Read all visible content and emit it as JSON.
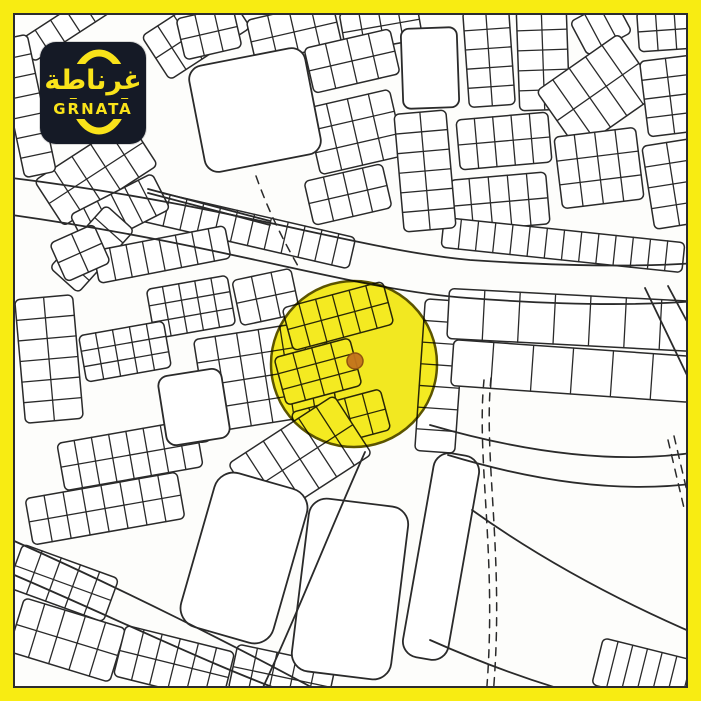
{
  "frame": {
    "border_color": "#f8ec12",
    "inner_line_color": "#2d2d2d",
    "map_bg": "#fdfdfb",
    "border_width_px": 13
  },
  "logo": {
    "arabic": "غرناطة",
    "latin": "GRNATA",
    "bg_color": "#151a26",
    "accent_color": "#f9e31a"
  },
  "map": {
    "ink": "#2a2a2a",
    "highlight_circle": {
      "cx": 354,
      "cy": 364,
      "r": 83,
      "fill": "#f2e702",
      "stroke": "#5c5400"
    },
    "marker": {
      "cx": 355,
      "cy": 361,
      "r": 8,
      "fill": "#c2731c",
      "stroke": "#8f5210"
    },
    "blocks": [
      {
        "x": 148,
        "y": 6,
        "w": 96,
        "h": 52,
        "rot": -33,
        "rows": 2,
        "cols": 5
      },
      {
        "x": 18,
        "y": 8,
        "w": 110,
        "h": 26,
        "rot": -33,
        "rows": 1,
        "cols": 6
      },
      {
        "x": 40,
        "y": 146,
        "w": 112,
        "h": 54,
        "rot": -33,
        "rows": 2,
        "cols": 5
      },
      {
        "x": 10,
        "y": 36,
        "w": 32,
        "h": 140,
        "rot": -12,
        "rows": 7,
        "cols": 1
      },
      {
        "x": 180,
        "y": 12,
        "w": 58,
        "h": 42,
        "rot": -13,
        "rows": 2,
        "cols": 3
      },
      {
        "x": 250,
        "y": 10,
        "w": 88,
        "h": 44,
        "rot": -13,
        "rows": 2,
        "cols": 4
      },
      {
        "x": 342,
        "y": 6,
        "w": 78,
        "h": 40,
        "rot": -10,
        "rows": 2,
        "cols": 4
      },
      {
        "x": 308,
        "y": 38,
        "w": 88,
        "h": 46,
        "rot": -13,
        "rows": 2,
        "cols": 4
      },
      {
        "x": 312,
        "y": 98,
        "w": 86,
        "h": 68,
        "rot": -13,
        "rows": 3,
        "cols": 4
      },
      {
        "x": 308,
        "y": 172,
        "w": 80,
        "h": 45,
        "rot": -13,
        "rows": 2,
        "cols": 4
      },
      {
        "x": 232,
        "y": 80,
        "w": 64,
        "h": 30,
        "rot": -11,
        "rows": 2,
        "cols": 3
      },
      {
        "x": 222,
        "y": 116,
        "w": 76,
        "h": 36,
        "rot": -11,
        "rows": 2,
        "cols": 4
      },
      {
        "x": 130,
        "y": 212,
        "w": 225,
        "h": 32,
        "rot": 13,
        "rows": 1,
        "cols": 13
      },
      {
        "x": 74,
        "y": 192,
        "w": 92,
        "h": 40,
        "rot": -27,
        "rows": 1,
        "cols": 6
      },
      {
        "x": 50,
        "y": 230,
        "w": 84,
        "h": 38,
        "rot": -48,
        "rows": 1,
        "cols": 5
      },
      {
        "x": 466,
        "y": 10,
        "w": 46,
        "h": 96,
        "rot": -4,
        "rows": 5,
        "cols": 2
      },
      {
        "x": 518,
        "y": 10,
        "w": 50,
        "h": 100,
        "rot": -2,
        "rows": 5,
        "cols": 2
      },
      {
        "x": 576,
        "y": 8,
        "w": 50,
        "h": 38,
        "rot": -28,
        "rows": 1,
        "cols": 3
      },
      {
        "x": 548,
        "y": 56,
        "w": 100,
        "h": 72,
        "rot": -35,
        "rows": 2,
        "cols": 5
      },
      {
        "x": 638,
        "y": 10,
        "w": 56,
        "h": 40,
        "rot": -4,
        "rows": 2,
        "cols": 3
      },
      {
        "x": 644,
        "y": 58,
        "w": 52,
        "h": 76,
        "rot": -7,
        "rows": 4,
        "cols": 2
      },
      {
        "x": 648,
        "y": 142,
        "w": 50,
        "h": 84,
        "rot": -9,
        "rows": 4,
        "cols": 2
      },
      {
        "x": 458,
        "y": 116,
        "w": 92,
        "h": 50,
        "rot": -5,
        "rows": 2,
        "cols": 5
      },
      {
        "x": 558,
        "y": 132,
        "w": 82,
        "h": 72,
        "rot": -7,
        "rows": 3,
        "cols": 4
      },
      {
        "x": 452,
        "y": 176,
        "w": 96,
        "h": 52,
        "rot": -5,
        "rows": 2,
        "cols": 5
      },
      {
        "x": 442,
        "y": 230,
        "w": 242,
        "h": 30,
        "rot": 6,
        "rows": 1,
        "cols": 14
      },
      {
        "x": 399,
        "y": 112,
        "w": 52,
        "h": 118,
        "rot": -5,
        "rows": 6,
        "cols": 2
      },
      {
        "x": 95,
        "y": 238,
        "w": 134,
        "h": 33,
        "rot": -11,
        "rows": 1,
        "cols": 8
      },
      {
        "x": 56,
        "y": 232,
        "w": 48,
        "h": 42,
        "rot": -24,
        "rows": 2,
        "cols": 2
      },
      {
        "x": 150,
        "y": 282,
        "w": 82,
        "h": 50,
        "rot": -10,
        "rows": 3,
        "cols": 5
      },
      {
        "x": 82,
        "y": 328,
        "w": 86,
        "h": 47,
        "rot": -10,
        "rows": 3,
        "cols": 5
      },
      {
        "x": 20,
        "y": 297,
        "w": 58,
        "h": 124,
        "rot": -5,
        "rows": 6,
        "cols": 2
      },
      {
        "x": 200,
        "y": 329,
        "w": 131,
        "h": 94,
        "rot": -9,
        "rows": 4,
        "cols": 6
      },
      {
        "x": 236,
        "y": 274,
        "w": 60,
        "h": 46,
        "rot": -12,
        "rows": 2,
        "cols": 3
      },
      {
        "x": 60,
        "y": 431,
        "w": 140,
        "h": 48,
        "rot": -10,
        "rows": 2,
        "cols": 8
      },
      {
        "x": 28,
        "y": 485,
        "w": 154,
        "h": 47,
        "rot": -10,
        "rows": 2,
        "cols": 8
      },
      {
        "x": 196,
        "y": 428,
        "w": 14,
        "h": 14,
        "rot": -9,
        "rows": 1,
        "cols": 1
      },
      {
        "x": 286,
        "y": 294,
        "w": 104,
        "h": 44,
        "rot": -15,
        "rows": 2,
        "cols": 6
      },
      {
        "x": 279,
        "y": 347,
        "w": 78,
        "h": 49,
        "rot": -15,
        "rows": 3,
        "cols": 4
      },
      {
        "x": 295,
        "y": 400,
        "w": 92,
        "h": 42,
        "rot": -15,
        "rows": 2,
        "cols": 5
      },
      {
        "x": 237,
        "y": 424,
        "w": 126,
        "h": 70,
        "rot": -33,
        "rows": 2,
        "cols": 6
      },
      {
        "x": 420,
        "y": 300,
        "w": 40,
        "h": 152,
        "rot": 4,
        "rows": 7,
        "cols": 1
      },
      {
        "x": 448,
        "y": 295,
        "w": 248,
        "h": 50,
        "rot": 3,
        "rows": 1,
        "cols": 7
      },
      {
        "x": 452,
        "y": 348,
        "w": 240,
        "h": 46,
        "rot": 4,
        "rows": 1,
        "cols": 6
      },
      {
        "x": 12,
        "y": 560,
        "w": 102,
        "h": 46,
        "rot": 20,
        "rows": 2,
        "cols": 5
      },
      {
        "x": 14,
        "y": 612,
        "w": 106,
        "h": 56,
        "rot": 17,
        "rows": 2,
        "cols": 5
      },
      {
        "x": 118,
        "y": 638,
        "w": 112,
        "h": 52,
        "rot": 14,
        "rows": 2,
        "cols": 6
      },
      {
        "x": 232,
        "y": 654,
        "w": 100,
        "h": 46,
        "rot": 12,
        "rows": 2,
        "cols": 5
      },
      {
        "x": 596,
        "y": 650,
        "w": 106,
        "h": 48,
        "rot": 14,
        "rows": 1,
        "cols": 7
      }
    ],
    "open_parcels": [
      {
        "x": 196,
        "y": 56,
        "w": 118,
        "h": 108,
        "rot": -11,
        "rx": 14
      },
      {
        "x": 402,
        "y": 28,
        "w": 56,
        "h": 80,
        "rot": -2,
        "rx": 8
      },
      {
        "x": 162,
        "y": 372,
        "w": 64,
        "h": 70,
        "rot": -9,
        "rx": 10
      },
      {
        "x": 196,
        "y": 478,
        "w": 96,
        "h": 160,
        "rot": 16,
        "rx": 20
      },
      {
        "x": 300,
        "y": 502,
        "w": 100,
        "h": 174,
        "rot": 7,
        "rx": 18
      },
      {
        "x": 418,
        "y": 453,
        "w": 46,
        "h": 207,
        "rot": 10,
        "rx": 16
      }
    ],
    "road_edges": [
      "M12 178 C230 205 360 250 470 260 C560 266 640 267 697 263",
      "M12 215 C230 246 355 290 468 298 C560 305 635 306 697 301",
      "M148 189 L270 221",
      "M148 193 L270 225",
      "M12 540 C120 588 240 648 335 700",
      "M12 574 C115 618 225 672 308 700",
      "M365 452 C330 530 295 620 258 698",
      "M430 425 Q585 470 698 452",
      "M448 455 Q590 498 698 483",
      "M472 510 Q570 580 698 635",
      "M430 640 Q520 680 600 700",
      "M645 288 L698 398",
      "M668 286 L698 342"
    ],
    "dashed_lines": [
      "M484 380 C476 460 498 560 486 698",
      "M491 378 C483 458 505 558 493 696",
      "M668 440 L684 508",
      "M674 436 L690 504",
      "M256 176 C268 210 282 238 298 266"
    ]
  }
}
